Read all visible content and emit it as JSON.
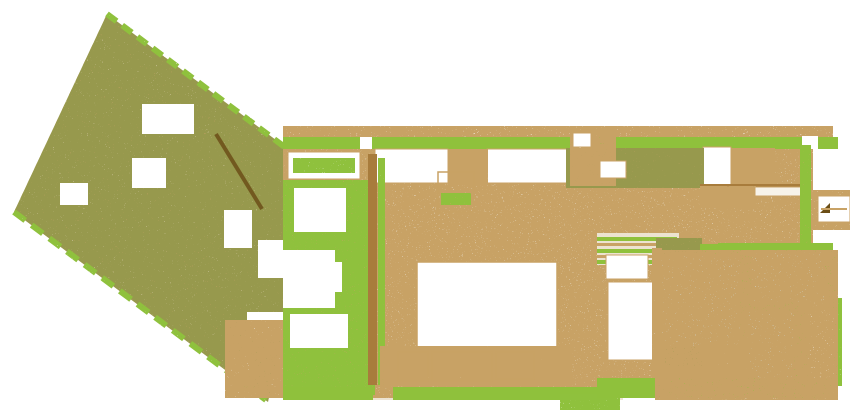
{
  "canvas": {
    "width": 850,
    "height": 413,
    "background": "#ffffff"
  },
  "palette": {
    "green": "#8fc13c",
    "green_light": "#b5d36e",
    "beige": "#ece3d1",
    "beige_deep": "#e2d5b6",
    "tan": "#c8a265",
    "brown": "#a87c3c",
    "brown_dark": "#6b4e17",
    "olive": "#97994e",
    "blue": "#d7e6ea",
    "white": "#ffffff",
    "cream": "#f7f3ea"
  },
  "textures": {
    "speckle-dense": {
      "freq": 0.9,
      "oct": 2,
      "seed": 3,
      "off": -4.6
    },
    "speckle-med": {
      "freq": 0.9,
      "oct": 2,
      "seed": 7,
      "off": -5.1
    },
    "speckle-light": {
      "freq": 0.85,
      "oct": 2,
      "seed": 11,
      "off": -5.3
    },
    "speckle-sparse": {
      "freq": 0.95,
      "oct": 2,
      "seed": 5,
      "off": -5.5
    },
    "speckle-faint": {
      "freq": 0.95,
      "oct": 2,
      "seed": 9,
      "off": -5.8
    }
  },
  "stripe_pattern": {
    "size": 16,
    "bar_width": 6,
    "rotate_deg": -52,
    "color_key": "tan"
  },
  "plan": {
    "shapes": [
      {
        "n": "garden-bed-base",
        "k": "poly",
        "pts": [
          [
            107,
            14
          ],
          [
            292,
            152
          ],
          [
            302,
            240
          ],
          [
            268,
            402
          ],
          [
            14,
            212
          ]
        ],
        "f": "beige_deep",
        "fl": "speckle-dense"
      },
      {
        "n": "garden-stripe-rows",
        "k": "poly",
        "pts": [
          [
            107,
            14
          ],
          [
            292,
            152
          ],
          [
            302,
            240
          ],
          [
            268,
            402
          ],
          [
            14,
            212
          ]
        ],
        "f": "stripes",
        "fl": "speckle-med"
      },
      {
        "n": "garden-olive-speckle",
        "k": "poly",
        "pts": [
          [
            107,
            14
          ],
          [
            292,
            152
          ],
          [
            302,
            240
          ],
          [
            268,
            402
          ],
          [
            14,
            212
          ]
        ],
        "f": "olive",
        "fl": "speckle-sparse"
      },
      {
        "n": "garden-hedge-upper",
        "k": "line",
        "x1": 107,
        "y1": 14,
        "x2": 290,
        "y2": 151,
        "s": "green",
        "sw": 6,
        "da": "12 7",
        "fl": "speckle-light"
      },
      {
        "n": "garden-hedge-lower",
        "k": "line",
        "x1": 14,
        "y1": 212,
        "x2": 266,
        "y2": 400,
        "s": "green",
        "sw": 6,
        "da": "14 8",
        "fl": "speckle-light"
      },
      {
        "n": "garden-ramp-wall",
        "k": "line",
        "x1": 216,
        "y1": 134,
        "x2": 262,
        "y2": 209,
        "s": "brown_dark",
        "sw": 4,
        "o": 0.85
      },
      {
        "n": "garden-clearing-1",
        "k": "rect",
        "x": 142,
        "y": 104,
        "w": 52,
        "h": 30,
        "f": "white"
      },
      {
        "n": "garden-clearing-2",
        "k": "rect",
        "x": 132,
        "y": 158,
        "w": 34,
        "h": 30,
        "f": "white"
      },
      {
        "n": "garden-clearing-3",
        "k": "rect",
        "x": 60,
        "y": 183,
        "w": 28,
        "h": 22,
        "f": "white"
      },
      {
        "n": "garden-clearing-4",
        "k": "rect",
        "x": 224,
        "y": 210,
        "w": 28,
        "h": 38,
        "f": "white"
      },
      {
        "n": "garden-clearing-5",
        "k": "rect",
        "x": 258,
        "y": 240,
        "w": 30,
        "h": 38,
        "f": "white"
      },
      {
        "n": "garden-clearing-6",
        "k": "rect",
        "x": 247,
        "y": 312,
        "w": 40,
        "h": 28,
        "f": "white"
      },
      {
        "n": "garden-clearing-7",
        "k": "rect",
        "x": 229,
        "y": 355,
        "w": 20,
        "h": 22,
        "f": "white"
      },
      {
        "n": "drive-speckle",
        "k": "rect",
        "x": 225,
        "y": 320,
        "w": 60,
        "h": 78,
        "f": "tan",
        "fl": "speckle-med"
      },
      {
        "n": "floor-main",
        "k": "rect",
        "x": 283,
        "y": 148,
        "w": 530,
        "h": 106,
        "f": "beige"
      },
      {
        "n": "floor-left-wing",
        "k": "rect",
        "x": 283,
        "y": 254,
        "w": 340,
        "h": 146,
        "f": "beige"
      },
      {
        "n": "pool-area-ground",
        "k": "rect",
        "x": 655,
        "y": 250,
        "w": 183,
        "h": 150,
        "f": "cream"
      },
      {
        "n": "floor-grain",
        "k": "rect",
        "x": 283,
        "y": 148,
        "w": 530,
        "h": 250,
        "f": "tan",
        "fl": "speckle-faint"
      },
      {
        "n": "top-fringe-speckle",
        "k": "rect",
        "x": 283,
        "y": 126,
        "w": 550,
        "h": 12,
        "f": "tan",
        "fl": "speckle-sparse"
      },
      {
        "n": "hedge-top",
        "k": "rect",
        "x": 283,
        "y": 137,
        "w": 555,
        "h": 12,
        "f": "green"
      },
      {
        "n": "hedge-top-gap-left",
        "k": "rect",
        "x": 360,
        "y": 137,
        "w": 12,
        "h": 12,
        "f": "white"
      },
      {
        "n": "hedge-top-gap-door",
        "k": "rect",
        "x": 576,
        "y": 134,
        "w": 22,
        "h": 15,
        "f": "white",
        "s": "brown",
        "sw": 1
      },
      {
        "n": "hedge-top-gap-right",
        "k": "rect",
        "x": 802,
        "y": 136,
        "w": 16,
        "h": 13,
        "f": "white"
      },
      {
        "n": "window-1-frame",
        "k": "rect",
        "x": 288,
        "y": 152,
        "w": 72,
        "h": 27,
        "f": "white",
        "s": "tan",
        "sw": 1
      },
      {
        "n": "window-1-planter",
        "k": "rect",
        "x": 293,
        "y": 158,
        "w": 62,
        "h": 15,
        "f": "green",
        "fl": "speckle-light"
      },
      {
        "n": "window-2",
        "k": "rect",
        "x": 375,
        "y": 149,
        "w": 73,
        "h": 34,
        "f": "white",
        "s": "tan",
        "sw": 1
      },
      {
        "n": "window-3",
        "k": "rect",
        "x": 487,
        "y": 149,
        "w": 81,
        "h": 34,
        "f": "white",
        "s": "tan",
        "sw": 1
      },
      {
        "n": "window-4",
        "k": "rect",
        "x": 654,
        "y": 151,
        "w": 34,
        "h": 31,
        "f": "white",
        "s": "tan",
        "sw": 1
      },
      {
        "n": "window-5",
        "k": "rect",
        "x": 703,
        "y": 147,
        "w": 28,
        "h": 39,
        "f": "white",
        "s": "tan",
        "sw": 1
      },
      {
        "n": "pier-speckle-1",
        "k": "rect",
        "x": 448,
        "y": 149,
        "w": 40,
        "h": 36,
        "f": "tan",
        "fl": "speckle-med"
      },
      {
        "n": "kitchen-speckle-tan",
        "k": "rect",
        "x": 566,
        "y": 148,
        "w": 138,
        "h": 40,
        "f": "tan",
        "fl": "speckle-dense"
      },
      {
        "n": "kitchen-speckle-olv",
        "k": "rect",
        "x": 566,
        "y": 148,
        "w": 138,
        "h": 40,
        "f": "olive",
        "fl": "speckle-med"
      },
      {
        "n": "pier-speckle-2",
        "k": "rect",
        "x": 731,
        "y": 148,
        "w": 44,
        "h": 40,
        "f": "tan",
        "fl": "speckle-med"
      },
      {
        "n": "left-wing-speckle",
        "k": "rect",
        "x": 283,
        "y": 180,
        "w": 92,
        "h": 215,
        "f": "tan",
        "fl": "speckle-med"
      },
      {
        "n": "left-wing-greenery",
        "k": "rect",
        "x": 283,
        "y": 180,
        "w": 92,
        "h": 215,
        "f": "green",
        "fl": "speckle-sparse"
      },
      {
        "n": "dividing-wall",
        "k": "rect",
        "x": 368,
        "y": 154,
        "w": 9,
        "h": 231,
        "f": "brown"
      },
      {
        "n": "wall-side-hedge",
        "k": "rect",
        "x": 378,
        "y": 158,
        "w": 7,
        "h": 227,
        "f": "green",
        "fl": "speckle-med"
      },
      {
        "n": "room-nook-1",
        "k": "rect",
        "x": 294,
        "y": 188,
        "w": 52,
        "h": 44,
        "f": "white"
      },
      {
        "n": "room-nook-2",
        "k": "rect",
        "x": 283,
        "y": 250,
        "w": 52,
        "h": 58,
        "f": "white"
      },
      {
        "n": "room-nook-3",
        "k": "rect",
        "x": 302,
        "y": 262,
        "w": 40,
        "h": 30,
        "f": "white"
      },
      {
        "n": "room-nook-4",
        "k": "rect",
        "x": 290,
        "y": 314,
        "w": 58,
        "h": 34,
        "f": "white"
      },
      {
        "n": "entry-speckle",
        "k": "rect",
        "x": 570,
        "y": 130,
        "w": 46,
        "h": 56,
        "f": "tan",
        "fl": "speckle-med"
      },
      {
        "n": "entry-box-1",
        "k": "rect",
        "x": 573,
        "y": 133,
        "w": 18,
        "h": 14,
        "f": "white",
        "s": "tan",
        "sw": 1
      },
      {
        "n": "entry-box-2",
        "k": "rect",
        "x": 600,
        "y": 161,
        "w": 26,
        "h": 17,
        "f": "white",
        "s": "tan",
        "sw": 1
      },
      {
        "n": "cafe-table-outline",
        "k": "rect",
        "x": 438,
        "y": 172,
        "w": 36,
        "h": 40,
        "f": "none",
        "s": "tan",
        "sw": 1.5
      },
      {
        "n": "cafe-table-slats",
        "k": "rect",
        "x": 441,
        "y": 193,
        "w": 30,
        "h": 12,
        "f": "green",
        "fl": "speckle-light"
      },
      {
        "n": "terrace-rug",
        "k": "rect",
        "x": 417,
        "y": 262,
        "w": 140,
        "h": 85,
        "f": "white",
        "s": "tan",
        "sw": 1.5
      },
      {
        "n": "sofa-row-speckle",
        "k": "rect",
        "x": 380,
        "y": 346,
        "w": 192,
        "h": 40,
        "f": "tan",
        "fl": "speckle-med"
      },
      {
        "n": "sofa-1",
        "k": "rect",
        "x": 398,
        "y": 352,
        "w": 30,
        "h": 29,
        "f": "none",
        "s": "tan",
        "sw": 1.2
      },
      {
        "n": "sofa-2",
        "k": "rect",
        "x": 432,
        "y": 352,
        "w": 60,
        "h": 29,
        "f": "none",
        "s": "tan",
        "sw": 1.2
      },
      {
        "n": "sofa-3",
        "k": "rect",
        "x": 496,
        "y": 352,
        "w": 38,
        "h": 27,
        "f": "none",
        "s": "tan",
        "sw": 1.2
      },
      {
        "n": "hedge-bottom-left-a",
        "k": "rect",
        "x": 283,
        "y": 387,
        "w": 90,
        "h": 13,
        "f": "green"
      },
      {
        "n": "hedge-bottom-left-b",
        "k": "rect",
        "x": 393,
        "y": 387,
        "w": 207,
        "h": 13,
        "f": "green"
      },
      {
        "n": "hedge-bottom-fringe",
        "k": "rect",
        "x": 560,
        "y": 394,
        "w": 60,
        "h": 16,
        "f": "green",
        "fl": "speckle-sparse"
      },
      {
        "n": "stairs-base",
        "k": "rect",
        "x": 593,
        "y": 233,
        "w": 90,
        "h": 32,
        "f": "beige"
      },
      {
        "n": "stairs-tread-1",
        "k": "rect",
        "x": 597,
        "y": 237,
        "w": 80,
        "h": 4,
        "f": "green"
      },
      {
        "n": "stairs-tread-2",
        "k": "rect",
        "x": 597,
        "y": 243,
        "w": 80,
        "h": 3,
        "f": "tan"
      },
      {
        "n": "stairs-tread-3",
        "k": "rect",
        "x": 597,
        "y": 249,
        "w": 80,
        "h": 4,
        "f": "green"
      },
      {
        "n": "stairs-tread-4",
        "k": "rect",
        "x": 597,
        "y": 255,
        "w": 80,
        "h": 3,
        "f": "tan"
      },
      {
        "n": "stairs-tread-5",
        "k": "rect",
        "x": 597,
        "y": 260,
        "w": 80,
        "h": 4,
        "f": "green"
      },
      {
        "n": "stairs-rail-left",
        "k": "rect",
        "x": 591,
        "y": 233,
        "w": 6,
        "h": 32,
        "f": "tan",
        "fl": "speckle-med"
      },
      {
        "n": "stairs-rail-right",
        "k": "rect",
        "x": 679,
        "y": 233,
        "w": 6,
        "h": 32,
        "f": "tan",
        "fl": "speckle-med"
      },
      {
        "n": "sunbed-small",
        "k": "rect",
        "x": 606,
        "y": 255,
        "w": 42,
        "h": 24,
        "f": "white",
        "s": "tan",
        "sw": 1
      },
      {
        "n": "sunbed-large",
        "k": "rect",
        "x": 608,
        "y": 282,
        "w": 50,
        "h": 78,
        "f": "white",
        "s": "tan",
        "sw": 1
      },
      {
        "n": "planter-column-tan",
        "k": "rect",
        "x": 656,
        "y": 238,
        "w": 46,
        "h": 128,
        "f": "tan",
        "fl": "speckle-dense"
      },
      {
        "n": "planter-column-olive",
        "k": "rect",
        "x": 656,
        "y": 238,
        "w": 46,
        "h": 128,
        "f": "olive",
        "fl": "speckle-med"
      },
      {
        "n": "right-room-wall",
        "k": "rect",
        "x": 700,
        "y": 184,
        "w": 102,
        "h": 3,
        "f": "brown"
      },
      {
        "n": "right-room-speckle",
        "k": "rect",
        "x": 700,
        "y": 186,
        "w": 56,
        "h": 22,
        "f": "tan",
        "fl": "speckle-sparse"
      },
      {
        "n": "right-room-table",
        "k": "rect",
        "x": 755,
        "y": 187,
        "w": 48,
        "h": 9,
        "f": "cream",
        "s": "tan",
        "sw": 1
      },
      {
        "n": "right-room-hedge-east",
        "k": "rect",
        "x": 800,
        "y": 145,
        "w": 11,
        "h": 110,
        "f": "green",
        "fl": "speckle-light"
      },
      {
        "n": "right-room-hedge-south",
        "k": "rect",
        "x": 700,
        "y": 244,
        "w": 112,
        "h": 10,
        "f": "green"
      },
      {
        "n": "gate-speckle",
        "k": "rect",
        "x": 813,
        "y": 190,
        "w": 37,
        "h": 40,
        "f": "tan",
        "fl": "speckle-sparse"
      },
      {
        "n": "gate-frame",
        "k": "rect",
        "x": 818,
        "y": 196,
        "w": 32,
        "h": 26,
        "f": "white",
        "s": "tan",
        "sw": 1
      },
      {
        "n": "gate-arrow",
        "k": "poly",
        "pts": [
          [
            820,
            213
          ],
          [
            830,
            203
          ],
          [
            830,
            213
          ]
        ],
        "f": "brown_dark"
      },
      {
        "n": "gate-rail",
        "k": "line",
        "x1": 821,
        "y1": 209,
        "x2": 847,
        "y2": 209,
        "s": "tan",
        "sw": 2
      },
      {
        "n": "pool-hedge-top",
        "k": "rect",
        "x": 718,
        "y": 243,
        "w": 115,
        "h": 10,
        "f": "green"
      },
      {
        "n": "pool-main",
        "k": "rect",
        "x": 660,
        "y": 256,
        "w": 80,
        "h": 90,
        "f": "blue",
        "s": "tan",
        "sw": 1
      },
      {
        "n": "pool-hedge-mid-vert",
        "k": "rect",
        "x": 740,
        "y": 252,
        "w": 12,
        "h": 94,
        "f": "green"
      },
      {
        "n": "pool-upper-right",
        "k": "rect",
        "x": 752,
        "y": 252,
        "w": 72,
        "h": 50,
        "f": "blue",
        "s": "tan",
        "sw": 1
      },
      {
        "n": "pool-hedge-east",
        "k": "rect",
        "x": 824,
        "y": 252,
        "w": 12,
        "h": 58,
        "f": "green"
      },
      {
        "n": "pool-hedge-mid-horiz",
        "k": "rect",
        "x": 746,
        "y": 302,
        "w": 50,
        "h": 9,
        "f": "green"
      },
      {
        "n": "pool-lower",
        "k": "rect",
        "x": 746,
        "y": 311,
        "w": 48,
        "h": 70,
        "f": "blue",
        "s": "tan",
        "sw": 1
      },
      {
        "n": "pool-hedge-vert-2",
        "k": "rect",
        "x": 794,
        "y": 306,
        "w": 14,
        "h": 88,
        "f": "green"
      },
      {
        "n": "pool-patio-white",
        "k": "rect",
        "x": 808,
        "y": 314,
        "w": 28,
        "h": 66,
        "f": "white"
      },
      {
        "n": "pool-east-hedge-low",
        "k": "rect",
        "x": 834,
        "y": 298,
        "w": 8,
        "h": 88,
        "f": "green",
        "fl": "speckle-light"
      },
      {
        "n": "pool-left-border",
        "k": "rect",
        "x": 652,
        "y": 248,
        "w": 10,
        "h": 132,
        "f": "tan",
        "fl": "speckle-med"
      },
      {
        "n": "hedge-bottom-pool",
        "k": "rect",
        "x": 597,
        "y": 378,
        "w": 235,
        "h": 20,
        "f": "green"
      },
      {
        "n": "pool-speckle-overlay",
        "k": "rect",
        "x": 655,
        "y": 250,
        "w": 183,
        "h": 150,
        "f": "tan",
        "fl": "speckle-sparse"
      }
    ]
  }
}
